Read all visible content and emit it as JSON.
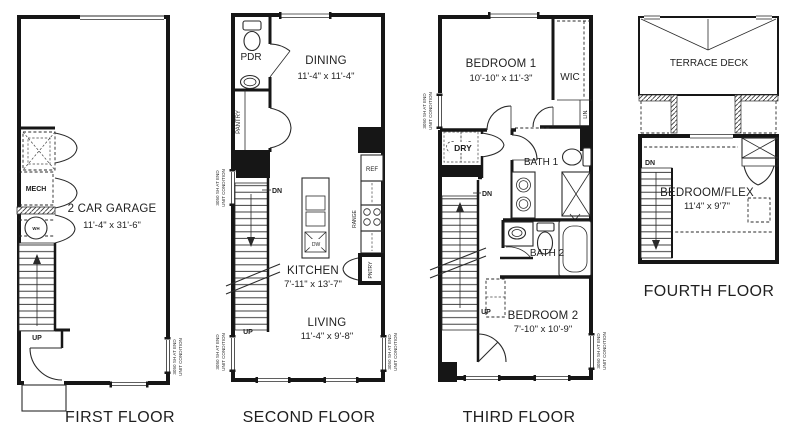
{
  "window_note": {
    "line1": "3050 SH AT END",
    "line2": "UNIT CONDITION"
  },
  "colors": {
    "line": "#161616",
    "text": "#1f1f1f",
    "background": "#ffffff"
  },
  "floor1": {
    "label": "FIRST FLOOR",
    "garage_name": "2 CAR GARAGE",
    "garage_dims": "11'-4\" x 31'-6\"",
    "mech": "MECH",
    "wh": "WH",
    "up": "UP"
  },
  "floor2": {
    "label": "SECOND FLOOR",
    "pdr": "PDR",
    "pantry": "PANTRY",
    "dining_name": "DINING",
    "dining_dims": "11'-4\" x 11'-4\"",
    "kitchen_name": "KITCHEN",
    "kitchen_dims": "7'-11\" x 13'-7\"",
    "living_name": "LIVING",
    "living_dims": "11'-4\" x 9'-8\"",
    "ref": "REF",
    "range": "RANGE",
    "pntry": "PNTRY",
    "dw": "DW",
    "dn": "DN",
    "up": "UP"
  },
  "floor3": {
    "label": "THIRD FLOOR",
    "bedroom1_name": "BEDROOM 1",
    "bedroom1_dims": "10'-10\" x 11'-3\"",
    "wic": "WIC",
    "lin": "LIN.",
    "dry": "DRY",
    "bath1": "BATH 1",
    "bath2": "BATH 2",
    "bedroom2_name": "BEDROOM 2",
    "bedroom2_dims": "7'-10\" x 10'-9\"",
    "dn": "DN",
    "up": "UP"
  },
  "floor4": {
    "label": "FOURTH FLOOR",
    "terrace": "TERRACE DECK",
    "flex_name": "BEDROOM/FLEX",
    "flex_dims": "11'4\" x 9'7\"",
    "dn": "DN"
  }
}
